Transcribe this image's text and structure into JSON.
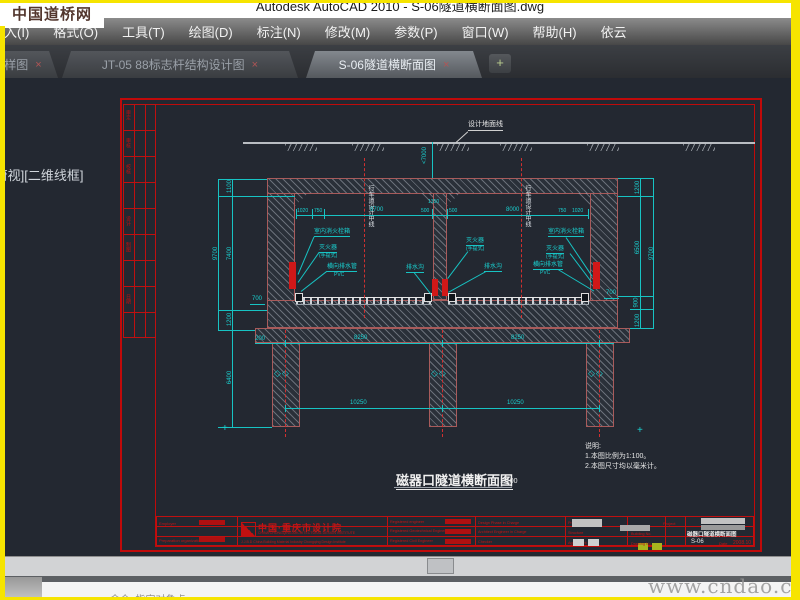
{
  "chrome": {
    "window_title": "Autodesk AutoCAD 2010 - S-06隧道横断面图.dwg",
    "wm_top": "中国道桥网",
    "wm_bottom": "www.cndao.com",
    "viewport_label": "[俯视][二维线框]",
    "command_prompt": "命令: 指定对角点:",
    "menu": {
      "items": [
        {
          "label": "入(I)"
        },
        {
          "label": "格式(O)"
        },
        {
          "label": "工具(T)"
        },
        {
          "label": "绘图(D)"
        },
        {
          "label": "标注(N)"
        },
        {
          "label": "修改(M)"
        },
        {
          "label": "参数(P)"
        },
        {
          "label": "窗口(W)"
        },
        {
          "label": "帮助(H)"
        },
        {
          "label": "依云"
        }
      ]
    },
    "tabs": {
      "t0": {
        "label": "样图",
        "close": "×"
      },
      "t1": {
        "label": "JT-05 88标志杆结构设计图",
        "close": "×"
      },
      "t2": {
        "label": "S-06隧道横断面图",
        "close": "×"
      },
      "plus": "+"
    }
  },
  "sheet": {
    "sig": {
      "s0": "审定",
      "s1": "审核",
      "s2": "校核",
      "s3": "设计",
      "s4": "制图",
      "s5": "日期"
    },
    "ground_label": "设计地面线",
    "depth": "<7000",
    "cl_text": "行车道设计中线",
    "dims": {
      "l1": "1100",
      "l2": "7400",
      "l3": "1200",
      "l_total": "9700",
      "l_pile": "6400",
      "r1": "1200",
      "r2": "6500",
      "r3": "900",
      "r4": "1200",
      "r_total": "9700",
      "t1": "1020",
      "t2": "750",
      "t3": "8700",
      "t4": "500",
      "wall": "1350",
      "t5": "500",
      "t6": "8000",
      "t7": "750",
      "t8": "1020",
      "b_edge": "200",
      "b1": "8250",
      "b2": "8250",
      "c1": "10250",
      "c2": "10250",
      "h_l": "700",
      "h_r": "700"
    },
    "ann": {
      "l_hydrant": "室内消火栓箱",
      "l_ext": "灭火器",
      "l_ext2": "(手提式)",
      "l_pipe": "横向排水管",
      "l_pipe2": "PVC",
      "l_drain": "排水沟",
      "r_ext": "灭火器",
      "r_ext2": "(手提式)",
      "r_drain": "排水沟",
      "r_hydrant": "室内消火栓箱",
      "r_ext_b": "灭火器",
      "r_ext_b2": "(手提式)",
      "r_pipe": "横向排水管",
      "r_pipe2": "PVC"
    },
    "notes": {
      "n0": "说明:",
      "n1": "1.本图比例为1:100。",
      "n2": "2.本图尺寸均以毫米计。"
    },
    "title": "磁器口隧道横断面图",
    "title_scale": "1:100",
    "tb": {
      "employer": "Employer",
      "prep": "Preparation organization",
      "org": "中国·重庆市设计院",
      "org_sub": "CHINA CHONGQING ARCHITECTURAL DESIGN INSTITUTE",
      "org_line": "J.J.B.D China Building Material Industry Chongqing Design Institute",
      "reg1": "Registered engineer",
      "reg2": "Registered Geotechnical Engineer",
      "reg3": "Registered Civil Engineer",
      "f1": "Design Phase in Charge",
      "f2": "Architect Engineer in Charge",
      "f3": "Checker",
      "g1": "Project",
      "g2": "Structure",
      "g3": "Agreement",
      "project": "Project",
      "building": "Building No.",
      "drawing_no_label": "Drawing No.",
      "name": "磁器口隧道横断面图",
      "no": "S-06",
      "date_label": "Date",
      "date": "2008.10"
    }
  }
}
